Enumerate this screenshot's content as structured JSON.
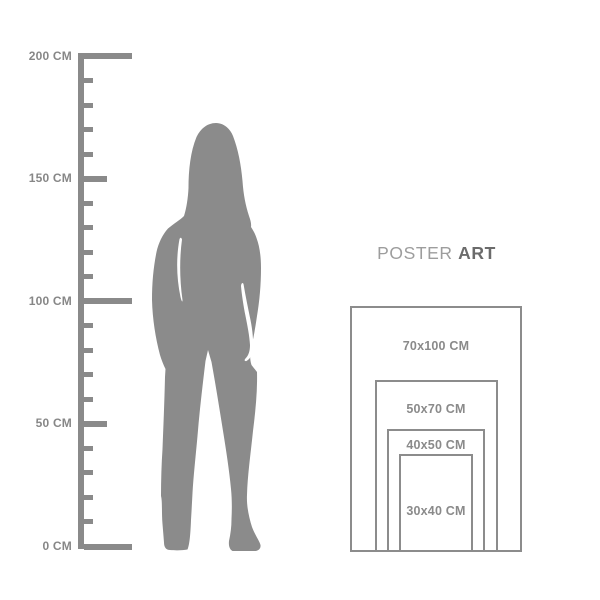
{
  "page": {
    "background": "#ffffff"
  },
  "ruler": {
    "unit": "CM",
    "min_value": 0,
    "max_value": 200,
    "minor_step": 10,
    "labels": [
      {
        "value": 200,
        "text": "200 CM"
      },
      {
        "value": 150,
        "text": "150 CM"
      },
      {
        "value": 100,
        "text": "100 CM"
      },
      {
        "value": 50,
        "text": "50 CM"
      },
      {
        "value": 0,
        "text": "0 CM"
      }
    ],
    "color": "#8a8a8a",
    "label_color": "#878787"
  },
  "figure": {
    "description": "standing woman silhouette for scale",
    "color": "#8b8b8b"
  },
  "brand": {
    "light": "POSTER",
    "bold": "ART",
    "light_color": "#9d9d9d",
    "bold_color": "#6b6b6b"
  },
  "poster_sizes": {
    "border_color": "#8c8c8c",
    "label_color": "#8a8a8a",
    "items": [
      {
        "label": "70x100 CM",
        "width_cm": 70,
        "height_cm": 100
      },
      {
        "label": "50x70 CM",
        "width_cm": 50,
        "height_cm": 70
      },
      {
        "label": "40x50 CM",
        "width_cm": 40,
        "height_cm": 50
      },
      {
        "label": "30x40 CM",
        "width_cm": 30,
        "height_cm": 40
      }
    ]
  }
}
